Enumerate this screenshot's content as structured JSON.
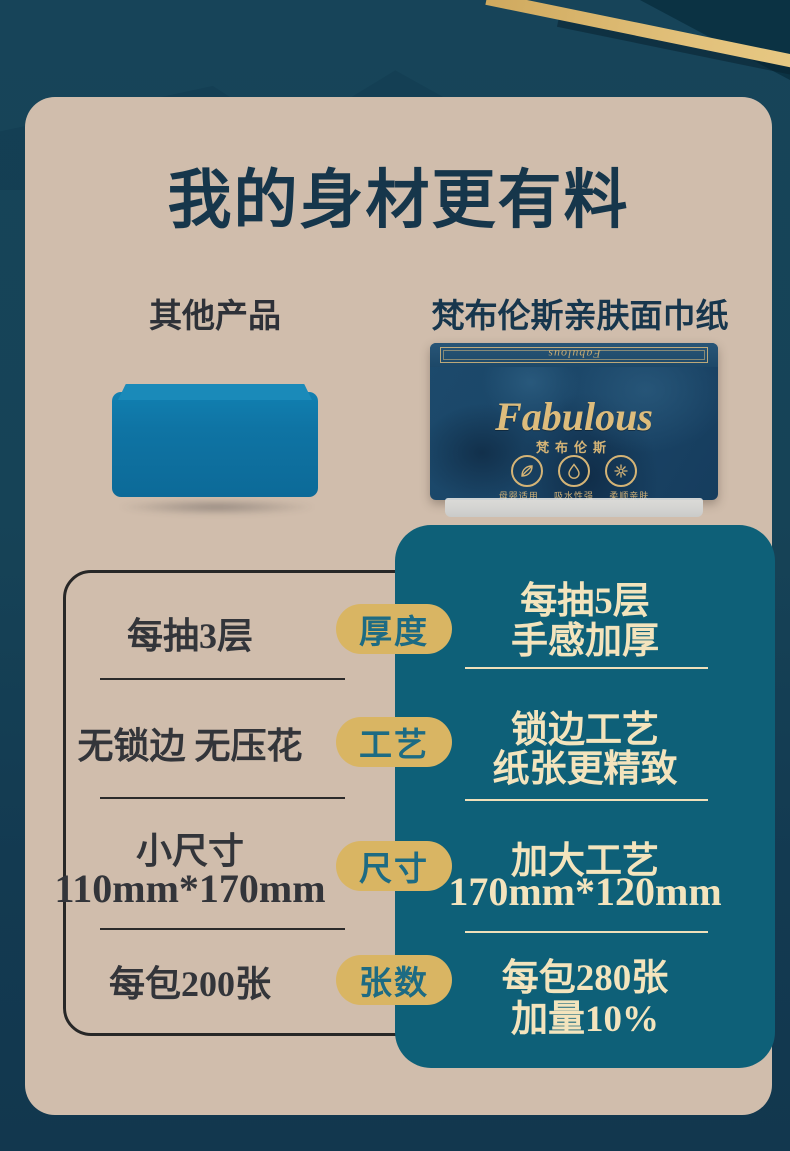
{
  "title": "我的身材更有料",
  "columns": {
    "other": "其他产品",
    "fabulous": "梵布伦斯亲肤面巾纸"
  },
  "package": {
    "lid_brand": "Fabulous",
    "brand_en": "Fabulous",
    "brand_cn": "梵布伦斯",
    "reg_mark": "®",
    "features": [
      {
        "icon": "leaf-icon",
        "label": "母婴适用"
      },
      {
        "icon": "droplet-icon",
        "label": "吸水性强"
      },
      {
        "icon": "flower-icon",
        "label": "柔顺亲肤"
      }
    ]
  },
  "comparison": {
    "rows": [
      {
        "label": "厚度",
        "other_lines": [
          "每抽3层"
        ],
        "fab_lines": [
          "每抽5层",
          "手感加厚"
        ]
      },
      {
        "label": "工艺",
        "other_lines": [
          "无锁边 无压花"
        ],
        "fab_lines": [
          "锁边工艺",
          "纸张更精致"
        ]
      },
      {
        "label": "尺寸",
        "other_lines": [
          "小尺寸",
          "110mm*170mm"
        ],
        "fab_lines": [
          "加大工艺",
          "170mm*120mm"
        ]
      },
      {
        "label": "张数",
        "other_lines": [
          "每包200张"
        ],
        "fab_lines": [
          "每包280张",
          "加量10%"
        ]
      }
    ]
  },
  "colors": {
    "background_teal": "#164357",
    "card_beige": "#d0bdac",
    "panel_teal": "#0e6078",
    "pill_gold": "#d9b563",
    "cream_text": "#f3e4bd",
    "title_navy": "#16364b",
    "gold_stripe": "#d9b369",
    "other_product_blue": "#1180ae"
  }
}
